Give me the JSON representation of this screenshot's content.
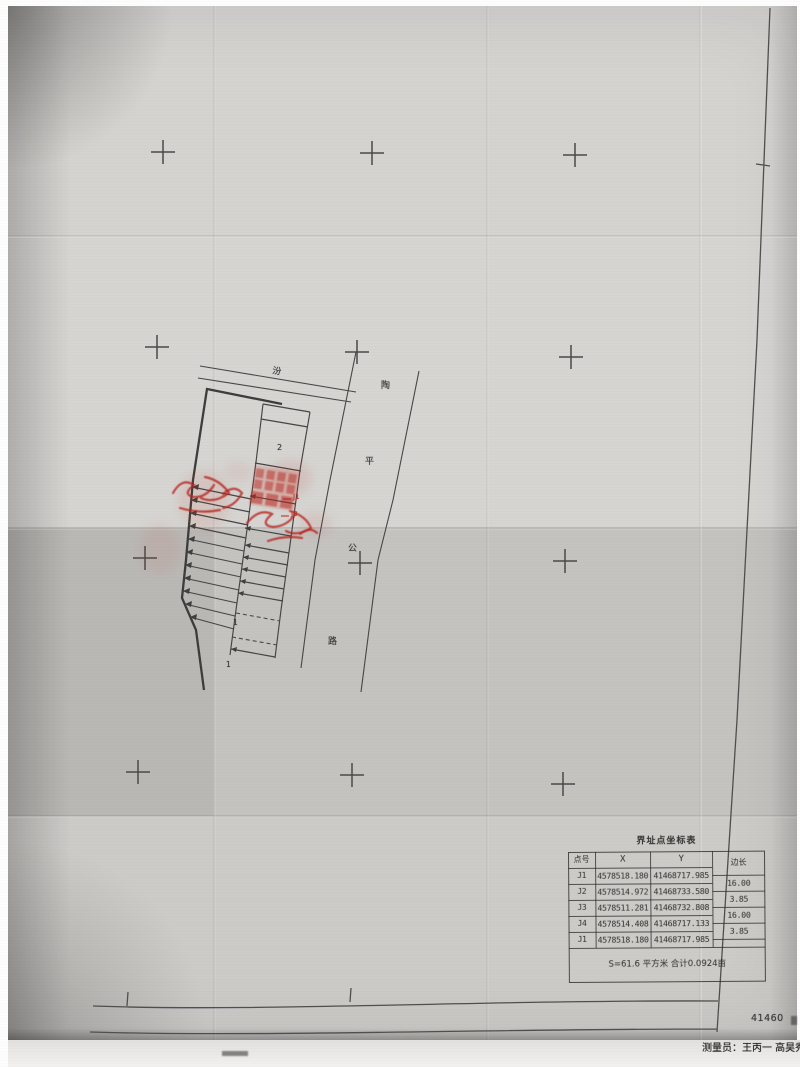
{
  "table": {
    "title": "界址点坐标表",
    "headers": [
      "点号",
      "X",
      "Y",
      "边长"
    ],
    "rows": [
      {
        "point": "J1",
        "x": "4578518.180",
        "y": "41468717.985"
      },
      {
        "point": "J2",
        "x": "4578514.972",
        "y": "41468733.580"
      },
      {
        "point": "J3",
        "x": "4578511.281",
        "y": "41468732.808"
      },
      {
        "point": "J4",
        "x": "4578514.408",
        "y": "41468717.133"
      },
      {
        "point": "J1",
        "x": "4578518.180",
        "y": "41468717.985"
      }
    ],
    "edge_lengths": [
      "16.00",
      "3.85",
      "16.00",
      "3.85"
    ],
    "footer": "S=61.6 平方米 合计0.0924亩"
  },
  "drawing": {
    "road_labels": [
      "汾",
      "陶",
      "平",
      "公",
      "路"
    ],
    "unit_labels": [
      "2",
      "1",
      "1"
    ],
    "red_point_labels": [
      "J1",
      "J3"
    ]
  },
  "frame": {
    "sheet_number": "41460"
  },
  "footer_line": {
    "surveyor": "测量员：王丙一  高昊秀"
  },
  "colors": {
    "paper": "#d0cecb",
    "ink": "#454545",
    "stamp_red": "#b8362a"
  }
}
